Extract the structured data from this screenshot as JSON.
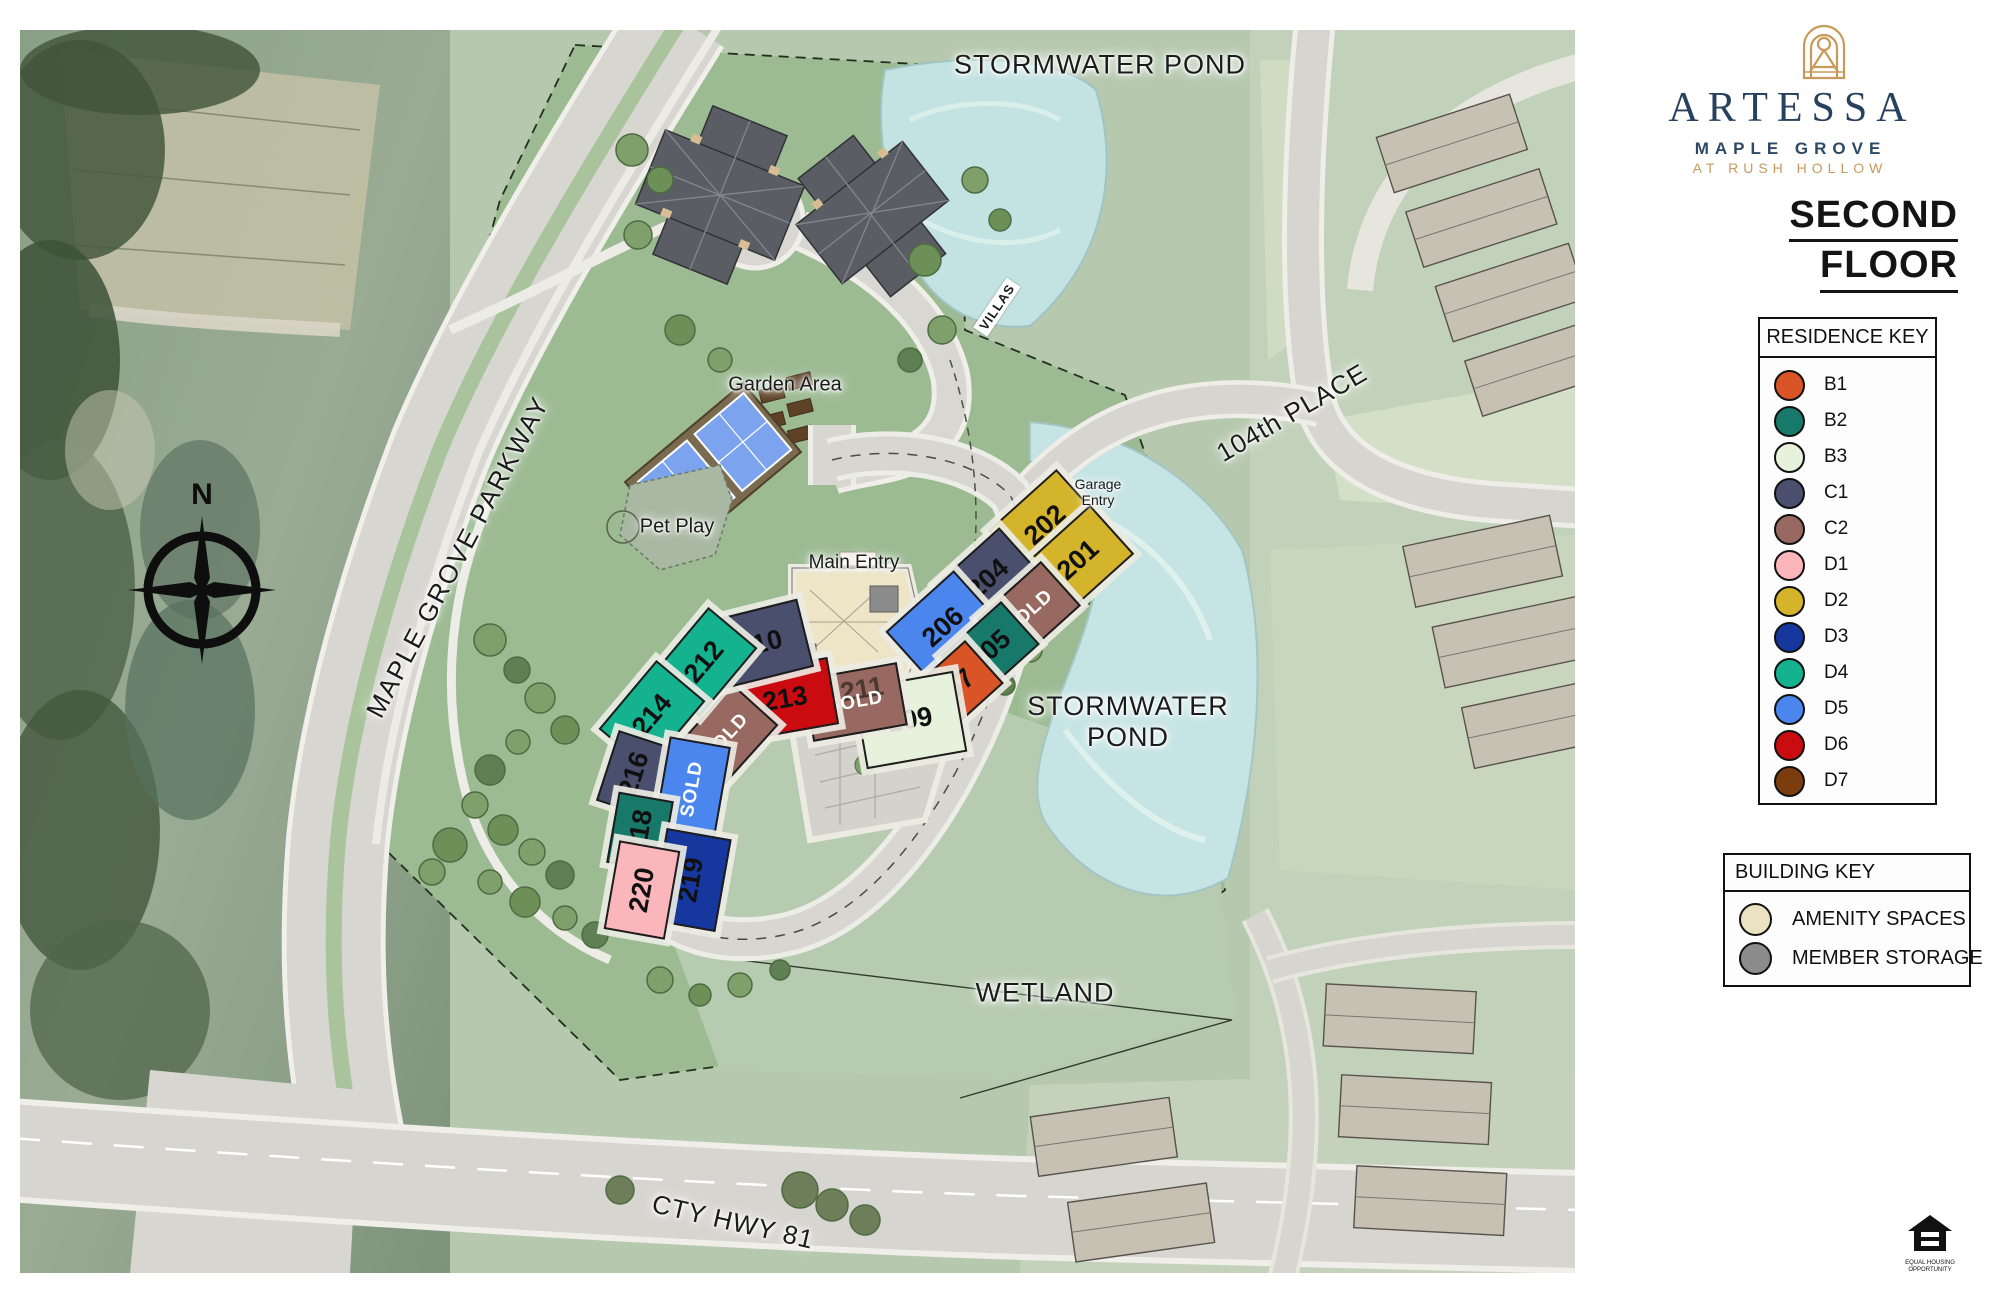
{
  "brand": {
    "name": "ARTESSA",
    "location": "MAPLE GROVE",
    "tagline": "AT RUSH HOLLOW",
    "floor_line1": "SECOND",
    "floor_line2": "FLOOR"
  },
  "residence_key": {
    "title": "RESIDENCE KEY",
    "items": [
      {
        "code": "B1",
        "color": "#D95427"
      },
      {
        "code": "B2",
        "color": "#17796A"
      },
      {
        "code": "B3",
        "color": "#E6F2DB"
      },
      {
        "code": "C1",
        "color": "#4A4F6E"
      },
      {
        "code": "C2",
        "color": "#976960"
      },
      {
        "code": "D1",
        "color": "#FBB6BB"
      },
      {
        "code": "D2",
        "color": "#D4B42A"
      },
      {
        "code": "D3",
        "color": "#16389E"
      },
      {
        "code": "D4",
        "color": "#14B28E"
      },
      {
        "code": "D5",
        "color": "#4B86EE"
      },
      {
        "code": "D6",
        "color": "#CA0B10"
      },
      {
        "code": "D7",
        "color": "#7C3D0E"
      }
    ]
  },
  "building_key": {
    "title": "BUILDING KEY",
    "items": [
      {
        "label": "AMENITY SPACES",
        "color": "#EAE2C2"
      },
      {
        "label": "MEMBER STORAGE",
        "color": "#8C8C8C"
      }
    ]
  },
  "map": {
    "sold_label": "SOLD",
    "labels": {
      "pond_top": "STORMWATER POND",
      "pond_right_line1": "STORMWATER",
      "pond_right_line2": "POND",
      "wetland": "WETLAND",
      "parkway": "MAPLE GROVE PARKWAY",
      "place_104": "104th PLACE",
      "hwy_81": "CTY HWY 81",
      "villas": "VILLAS",
      "garden": "Garden Area",
      "pet_play": "Pet Play",
      "main_entry": "Main Entry",
      "garage_line1": "Garage",
      "garage_line2": "Entry",
      "compass_n": "N"
    },
    "units": [
      {
        "number": "202",
        "type": "D2",
        "x": 1023,
        "y": 493,
        "w": 88,
        "h": 64,
        "rot": -42
      },
      {
        "number": "201",
        "type": "D2",
        "x": 1056,
        "y": 528,
        "w": 88,
        "h": 62,
        "rot": -42
      },
      {
        "number": "204",
        "type": "C1",
        "x": 966,
        "y": 547,
        "w": 82,
        "h": 58,
        "rot": -42
      },
      {
        "number": "206",
        "type": "D5",
        "x": 921,
        "y": 595,
        "w": 88,
        "h": 66,
        "rot": -42
      },
      {
        "number": "",
        "sold": true,
        "type": "C2",
        "x": 1007,
        "y": 580,
        "w": 82,
        "h": 56,
        "rot": -42
      },
      {
        "number": "205",
        "type": "B2",
        "x": 968,
        "y": 618,
        "w": 78,
        "h": 54,
        "rot": -42
      },
      {
        "number": "207",
        "type": "B1",
        "x": 932,
        "y": 657,
        "w": 78,
        "h": 54,
        "rot": -42
      },
      {
        "number": "209",
        "type": "B3",
        "x": 888,
        "y": 688,
        "w": 98,
        "h": 78,
        "rot": -10
      },
      {
        "number": "211",
        "sold": true,
        "type": "C2",
        "x": 833,
        "y": 670,
        "w": 92,
        "h": 60,
        "rot": -10
      },
      {
        "number": "213",
        "type": "D6",
        "x": 763,
        "y": 667,
        "w": 94,
        "h": 64,
        "rot": -10
      },
      {
        "number": "",
        "sold": true,
        "type": "C2",
        "x": 704,
        "y": 705,
        "w": 84,
        "h": 58,
        "rot": -48
      },
      {
        "number": "210",
        "type": "C1",
        "x": 738,
        "y": 612,
        "w": 90,
        "h": 66,
        "rot": -14
      },
      {
        "number": "212",
        "type": "D4",
        "x": 682,
        "y": 630,
        "w": 86,
        "h": 60,
        "rot": -50
      },
      {
        "number": "214",
        "type": "D4",
        "x": 630,
        "y": 683,
        "w": 86,
        "h": 60,
        "rot": -50
      },
      {
        "number": "216",
        "type": "C1",
        "x": 612,
        "y": 742,
        "w": 70,
        "h": 52,
        "rot": -72
      },
      {
        "number": "",
        "sold": true,
        "type": "D5",
        "x": 670,
        "y": 757,
        "w": 92,
        "h": 58,
        "rot": -80
      },
      {
        "number": "218",
        "type": "B2",
        "x": 618,
        "y": 800,
        "w": 68,
        "h": 52,
        "rot": -80
      },
      {
        "number": "219",
        "type": "D3",
        "x": 669,
        "y": 848,
        "w": 90,
        "h": 62,
        "rot": -80
      },
      {
        "number": "220",
        "type": "D1",
        "x": 620,
        "y": 858,
        "w": 86,
        "h": 58,
        "rot": -80
      }
    ]
  },
  "equal_housing": {
    "line1": "EQUAL HOUSING",
    "line2": "OPPORTUNITY"
  }
}
